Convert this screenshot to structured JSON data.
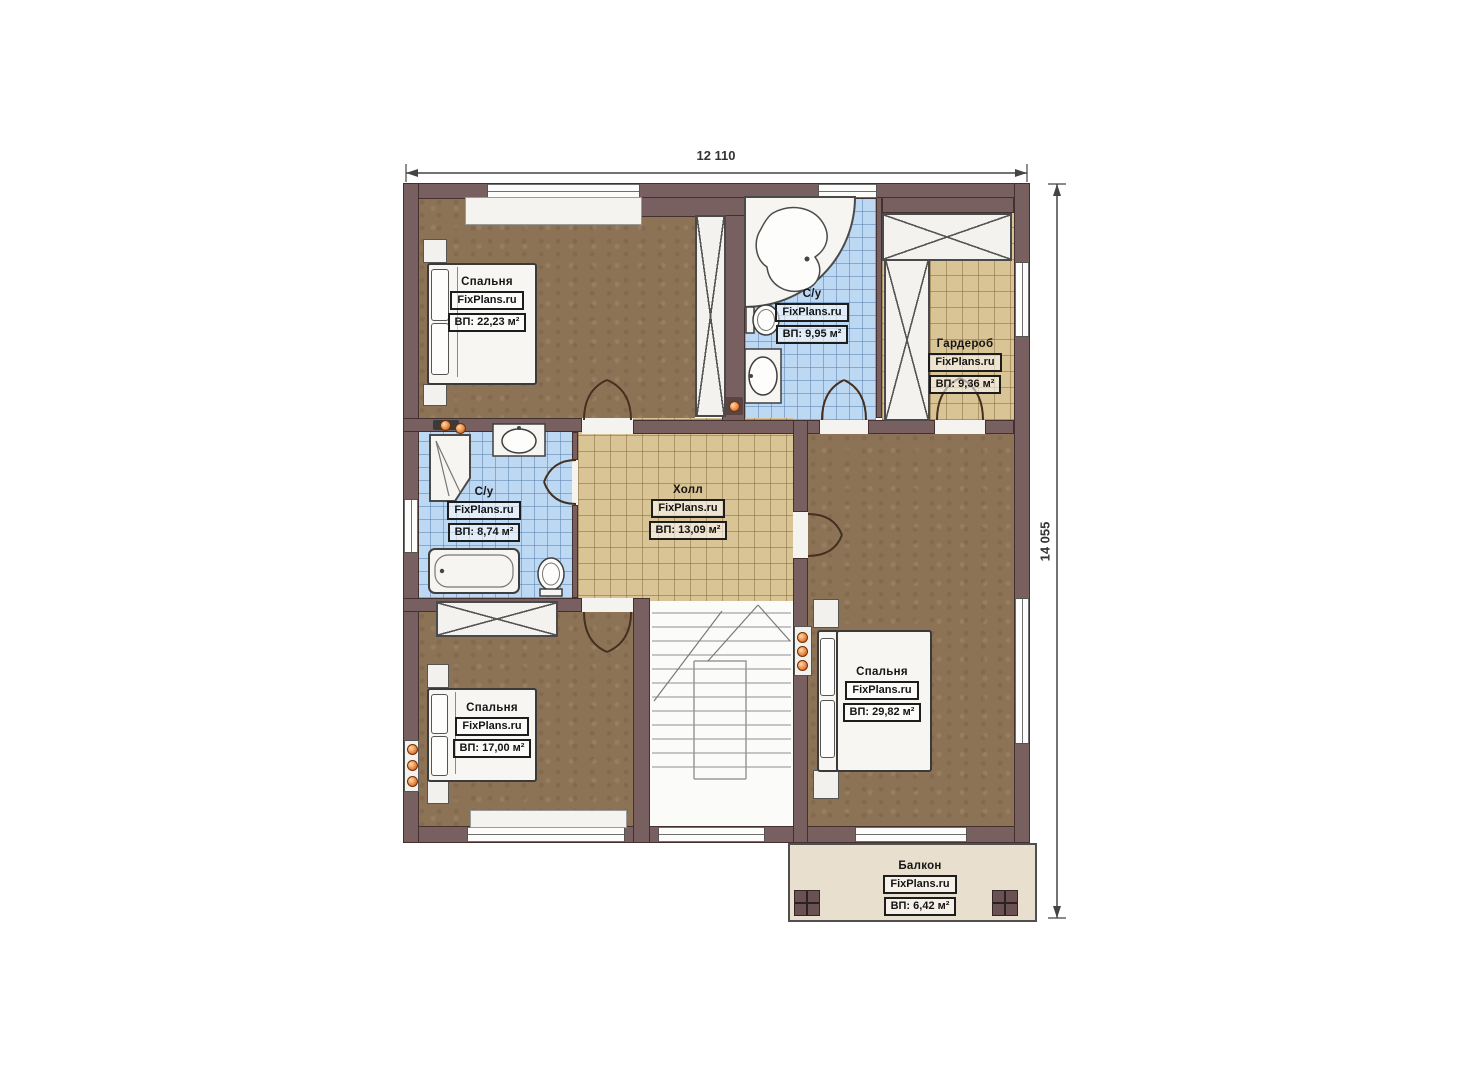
{
  "dimensions": {
    "width": "12 110",
    "height": "14 055"
  },
  "rooms": [
    {
      "key": "bedroom-top-left",
      "name": "Спальня",
      "brand": "FixPlans.ru",
      "area": "ВП: 22,23 м²"
    },
    {
      "key": "bathroom-top",
      "name": "С/у",
      "brand": "FixPlans.ru",
      "area": "ВП: 9,95 м²"
    },
    {
      "key": "wardrobe",
      "name": "Гардероб",
      "brand": "FixPlans.ru",
      "area": "ВП: 9,36 м²"
    },
    {
      "key": "bathroom-left",
      "name": "С/у",
      "brand": "FixPlans.ru",
      "area": "ВП: 8,74 м²"
    },
    {
      "key": "hall",
      "name": "Холл",
      "brand": "FixPlans.ru",
      "area": "ВП: 13,09 м²"
    },
    {
      "key": "bedroom-bottom-left",
      "name": "Спальня",
      "brand": "FixPlans.ru",
      "area": "ВП: 17,00 м²"
    },
    {
      "key": "bedroom-right",
      "name": "Спальня",
      "brand": "FixPlans.ru",
      "area": "ВП: 29,82 м²"
    },
    {
      "key": "balcony",
      "name": "Балкон",
      "brand": "FixPlans.ru",
      "area": "ВП: 6,42 м²"
    }
  ],
  "colors": {
    "wall": "#786060",
    "bedroom_floor": "#8d7356",
    "tile_blue": "#bdd8f2",
    "tile_tan": "#d9c495",
    "balcony_floor": "#e9dfce",
    "fixture_white": "#f6f5f2",
    "accent_dot": "#e8833e"
  }
}
